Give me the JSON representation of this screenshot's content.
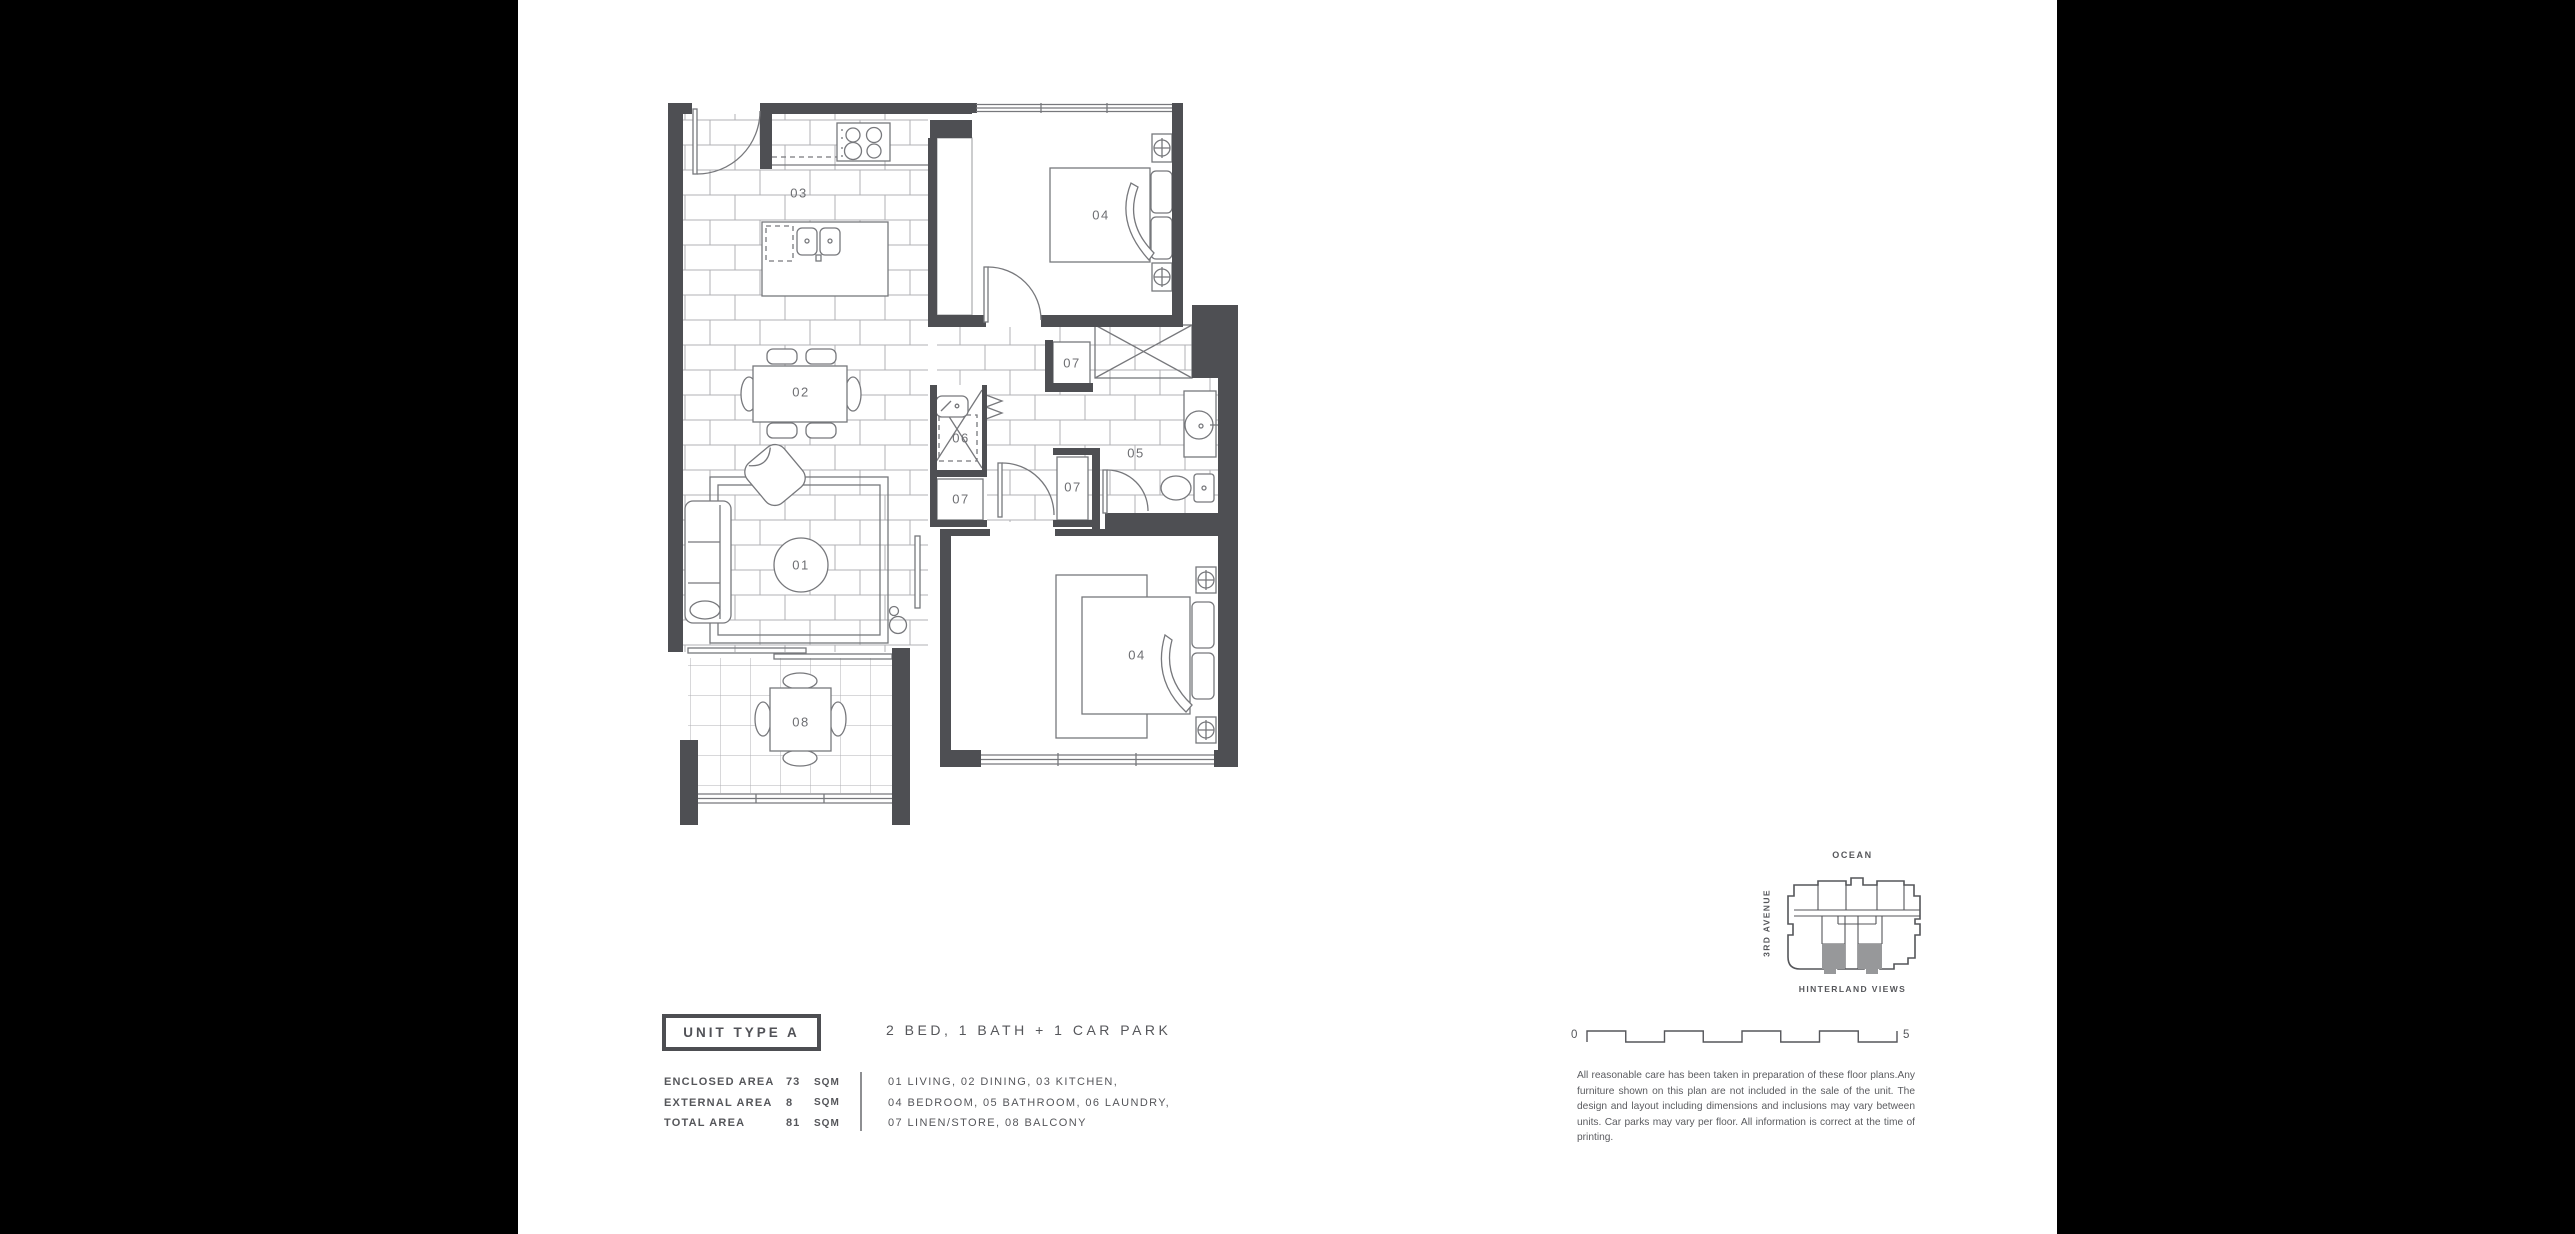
{
  "unit": {
    "type_label": "UNIT TYPE A",
    "config": "2 BED, 1 BATH + 1 CAR PARK"
  },
  "areas": [
    {
      "label": "ENCLOSED AREA",
      "value": "73",
      "unit": "SQM"
    },
    {
      "label": "EXTERNAL AREA",
      "value": "8",
      "unit": "SQM"
    },
    {
      "label": "TOTAL AREA",
      "value": "81",
      "unit": "SQM"
    }
  ],
  "legend": [
    "01 LIVING, 02 DINING, 03 KITCHEN,",
    "04 BEDROOM, 05 BATHROOM, 06 LAUNDRY,",
    "07 LINEN/STORE, 08 BALCONY"
  ],
  "plan": {
    "rooms": {
      "living": "01",
      "dining": "02",
      "kitchen": "03",
      "bedroom": "04",
      "bathroom": "05",
      "laundry": "06",
      "linen": "07",
      "balcony": "08"
    }
  },
  "key_plan": {
    "ocean": "OCEAN",
    "street": "3RD AVENUE",
    "hinterland": "HINTERLAND VIEWS"
  },
  "scale": {
    "start": "0",
    "end": "5"
  },
  "disclaimer": "All reasonable care has been taken in preparation of these floor plans.Any furniture shown on this plan are not included in the sale of the unit. The design and layout including dimensions and inclusions may vary between units. Car parks may vary per floor. All information is correct at the time of printing.",
  "colors": {
    "background": "#000000",
    "page": "#ffffff",
    "wall": "#4e4f53",
    "furniture_line": "#77787c",
    "tile_line": "#b0b1b4",
    "text": "#55565a",
    "keyplan_highlight": "#97989a"
  }
}
